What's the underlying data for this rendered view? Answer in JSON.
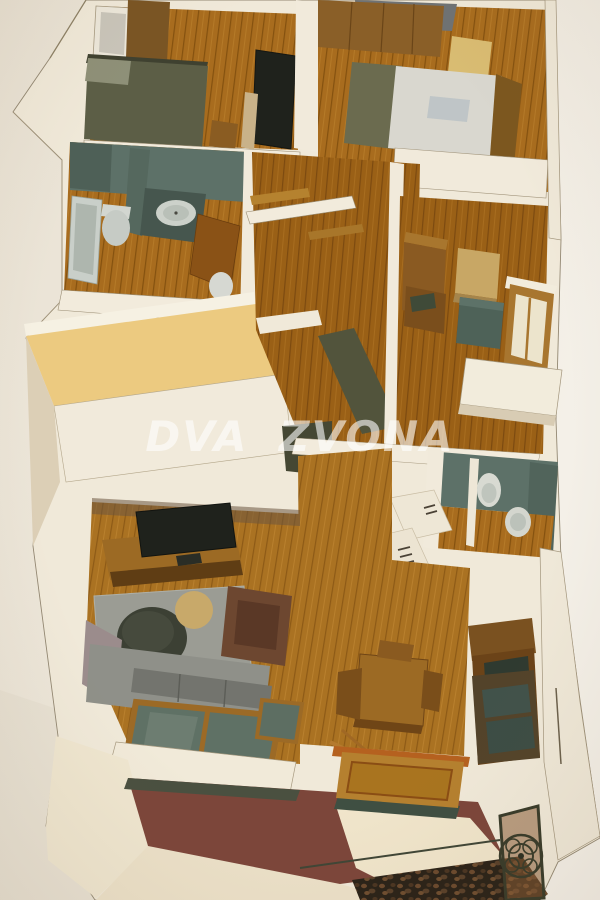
{
  "scene": {
    "description": "Photographed isometric cutaway 3D architectural model of an apartment floor plan",
    "watermark": {
      "text": "DVA ZVONA",
      "color": "#ffffff",
      "opacity": 0.6
    }
  },
  "palette": {
    "paper": "#ebe5d9",
    "wall_cream": "#f0e9d9",
    "wall_shadow": "#d9ccb3",
    "wall_top_yellow": "#ecca80",
    "wood_floor": "#a86c1e",
    "wood_dark": "#7c4e14",
    "bathroom_teal": "#5d7168",
    "fixture_white": "#d6d8d0",
    "bed_olive": "#5c5e46",
    "bedding_white": "#d9d7cf",
    "tv_black": "#1f221c",
    "rug_gray": "#9b9c94",
    "sofa_gray": "#8f9089",
    "armchair_brown": "#6d4730",
    "balcony_maroon": "#7c463a",
    "iron_railing": "#383b2a",
    "accent_yellow_cube": "#d9bc72",
    "glass_teal": "#5f7165",
    "cabinet_brown": "#8a5a22"
  },
  "rooms": [
    {
      "name": "bedroom-top-left",
      "furniture": [
        "wardrobe",
        "double-bed",
        "wall-tv",
        "tv-cabinet",
        "window"
      ]
    },
    {
      "name": "bedroom-top-right",
      "furniture": [
        "closet",
        "bed-with-white-bedding",
        "yellow-ottoman"
      ]
    },
    {
      "name": "bathroom-left",
      "furniture": [
        "bathtub",
        "toilet",
        "bidet",
        "vanity-washbasin",
        "open-door"
      ]
    },
    {
      "name": "entry-hall",
      "furniture": [
        "stair-flight",
        "wood-handrail",
        "door-frames"
      ]
    },
    {
      "name": "corridor-right",
      "furniture": [
        "cabinets",
        "tan-box",
        "teal-chest",
        "window",
        "balcony-ledge"
      ]
    },
    {
      "name": "bathroom-right",
      "furniture": [
        "toilet",
        "washbasin"
      ]
    },
    {
      "name": "kitchen",
      "furniture": [
        "white-cabinets-with-handles"
      ]
    },
    {
      "name": "dining-area",
      "furniture": [
        "square-table",
        "chairs",
        "tall-dark-cabinet"
      ]
    },
    {
      "name": "living-room",
      "furniture": [
        "flat-tv",
        "media-console",
        "gray-rug",
        "round-ottoman",
        "side-table",
        "armchair",
        "sofa",
        "glazed-window-wall"
      ]
    },
    {
      "name": "balcony",
      "furniture": [
        "maroon-floor",
        "wrought-iron-railing",
        "laid-wooden-door",
        "cobblestone-paving"
      ]
    }
  ]
}
